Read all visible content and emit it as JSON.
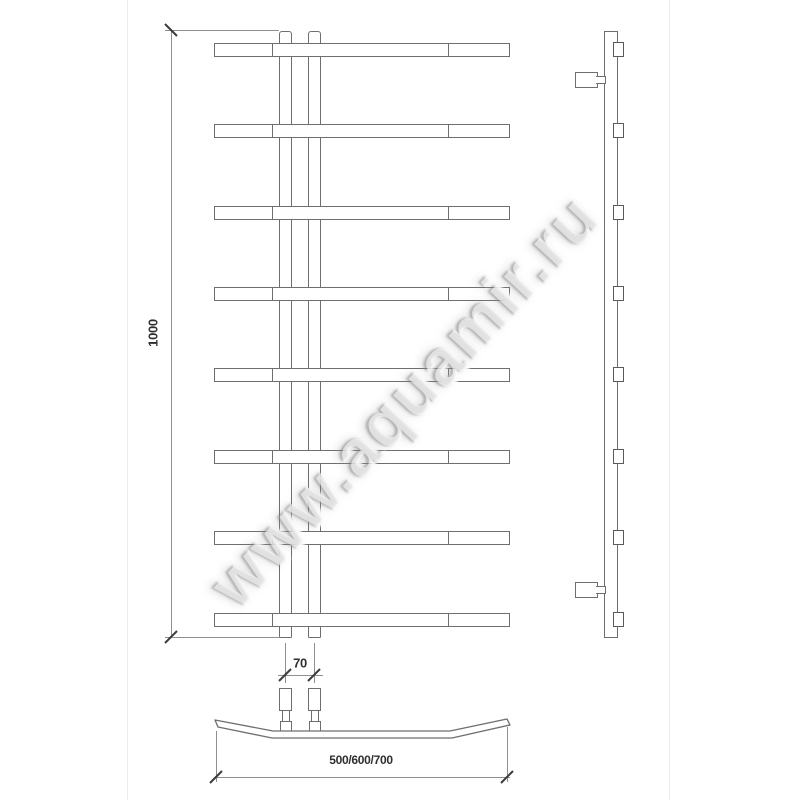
{
  "watermark": {
    "text": "www.aquamir.ru"
  },
  "dimensions": {
    "height_mm": "1000",
    "pipe_spacing_mm": "70",
    "width_options_mm": "500/600/700"
  },
  "views": {
    "front": {
      "bar_count": 8,
      "riser_pipe_count": 2
    },
    "side": {
      "rung_count": 8,
      "wall_bracket_count": 2
    },
    "bottom": {
      "connector_count": 2
    }
  }
}
